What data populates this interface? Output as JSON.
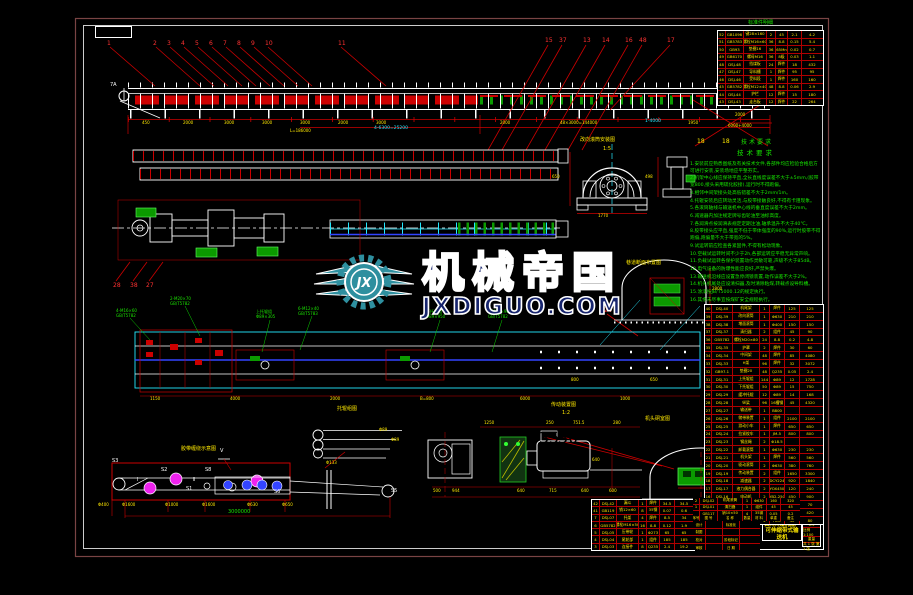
{
  "watermark": {
    "logo_initials": "JX",
    "brand": "机械帝国",
    "site": "JXDIGUO.COM"
  },
  "colors": {
    "red": "#cc1111",
    "yellow": "#ffe800",
    "green": "#1ae300",
    "cyan": "#25e9ff",
    "white": "#ffffff",
    "magenta": "#ee22ee",
    "blue": "#3344ff",
    "frame_outer": "#7a4444",
    "frame_inner": "#ffffff",
    "watermark_teal": "#2e8f9f",
    "watermark_navy": "#17256e"
  },
  "callouts": {
    "top_left": [
      "1",
      "2",
      "3",
      "4",
      "5",
      "6",
      "7",
      "8",
      "9",
      "10",
      "11"
    ],
    "top_right": [
      "15",
      "37",
      "13",
      "14",
      "16",
      "48",
      "17"
    ],
    "mid_left": [
      "28",
      "38",
      "27"
    ],
    "band3": [
      "24"
    ],
    "bottom": [
      "35",
      "30"
    ],
    "head_label": "7A"
  },
  "dims": {
    "top_row": [
      "450",
      "2000",
      "3000",
      "3000",
      "3000",
      "2000",
      "3000",
      "2000",
      "48×3000=144000",
      "1950"
    ],
    "top_row2": [
      "L=186000"
    ],
    "top_cyan": [
      "4-6300=25200",
      "1-4000"
    ],
    "band3_row": [
      "1150",
      "4000",
      "2000",
      "B=800",
      "6000",
      "1000"
    ],
    "band3_extra": [
      "800",
      "650"
    ],
    "detail_a": [
      "650",
      "1770"
    ],
    "detail_b": [
      "498"
    ],
    "tunnel_c": [
      "2800"
    ],
    "tunnel_d": [
      "650"
    ],
    "drive_top": [
      "1250",
      "250",
      "751.5",
      "280"
    ],
    "drive_bottom": [
      "500",
      "944",
      "640",
      "715",
      "640",
      "600"
    ],
    "drive_right": [
      "640"
    ],
    "head_leader": [
      "2000",
      "6000+4000"
    ]
  },
  "sections": {
    "detail_a_title": "改向滚筒安装图",
    "detail_a_scale": "1:5",
    "tunnel_c_title": "巷道断面布置图",
    "drive_title": "传动装置图",
    "drive_scale": "1:2",
    "rollers_title": "托辊组图",
    "rollers_labels": [
      "Φ89",
      "Φ89",
      "Φ133"
    ],
    "tunnel_d_title": "机头硐室图",
    "belt_title": "胶带缠绕示意图",
    "standard_label": "标准件明细"
  },
  "belt": {
    "labels": [
      "S3",
      "S2",
      "S8",
      "S1",
      "S6",
      "S5"
    ],
    "marks": [
      "Ⅰ",
      "Ⅱ"
    ],
    "v": "V",
    "phi": [
      "Φ400",
      "Φ1600",
      "Φ1000",
      "Φ1600",
      "Φ630",
      "Φ650"
    ],
    "total": "3000000"
  },
  "green_codes": [
    [
      "4-M16×60",
      "GB/T5782"
    ],
    [
      "2-M20×70",
      "GB/T5782"
    ],
    [
      "上托辊组",
      "Φ89×305"
    ],
    [
      "6-M12×40",
      "GB/T5783"
    ],
    [
      "下托辊组",
      "Φ89×950"
    ],
    [
      "2-M24×90",
      "GB/T5782"
    ]
  ],
  "notes": {
    "title": "技术要求",
    "lines": [
      "安装前应熟悉图纸及有关技术文件,各部件均应检验合格后方可进行安装,安装场地应平整夯实。",
      "机架中心线应保持平直,全长直线度误差不大于±5mm,(胶带宽800,接头采用硫化胶接),运行时不得跑偏。",
      "相邻中间架接头处高低错差不大于2mm/1m。",
      "托辊安装后应转动灵活,与胶带接触良好,不得有卡阻现象。",
      "各滚筒轴线与输送机中心线的垂直度误差不大于2mm。",
      "减速器内加注规定牌号齿轮油至油标高度。",
      "各润滑点按润滑表规定定期注油,轴承温升不大于40℃。",
      "胶带接头应平直,强度不低于带体强度的90%,运行时胶带不得跑偏,跑偏量不大于带宽的5%。",
      "试运转前应检查各紧固件,不得有松动现象。",
      "空载试运转时间不少于2h,各部运转应平稳无异常声响。",
      "负载试运转各保护装置动作灵敏可靠,声级不大于85dB。",
      "电气设备的防爆性能应良好,严禁失爆。",
      "输送机沿线应设置急停闭锁装置,动作误差不大于2%。",
      "机头机尾处应设清扫器,及时清除粘煤,转载点设导料槽。",
      "涂漆按JB/T5000.12的规定执行。",
      "其余未尽事宜按煤矿安全规程执行。"
    ]
  },
  "tables": {
    "top_right": {
      "rows": [
        [
          "52",
          "GB1096",
          "键28×160",
          "2",
          "45",
          "2.1",
          "4.2"
        ],
        [
          "51",
          "GB5783",
          "螺栓M16×60",
          "36",
          "8.8",
          "0.15",
          "5.4"
        ],
        [
          "50",
          "GB93",
          "垫圈16",
          "36",
          "65Mn",
          "0.02",
          "0.7"
        ],
        [
          "49",
          "GB6170",
          "螺母M16",
          "36",
          "8级",
          "0.03",
          "1.1"
        ],
        [
          "48",
          "DSJ-48",
          "挡煤板",
          "24",
          "焊件",
          "18",
          "432"
        ],
        [
          "47",
          "DSJ-47",
          "导料槽",
          "1",
          "焊件",
          "95",
          "95"
        ],
        [
          "46",
          "DSJ-46",
          "受料段",
          "1",
          "焊件",
          "160",
          "160"
        ],
        [
          "45",
          "GB5782",
          "螺栓M12×40",
          "48",
          "8.8",
          "0.06",
          "2.9"
        ],
        [
          "44",
          "DSJ-44",
          "护栏",
          "12",
          "焊件",
          "15",
          "180"
        ],
        [
          "43",
          "DSJ-43",
          "走台板",
          "12",
          "焊件",
          "22",
          "264"
        ]
      ]
    },
    "bom": {
      "rows": [
        [
          "40",
          "DSJ-40",
          "机尾架",
          "1",
          "焊件",
          "125",
          "125"
        ],
        [
          "39",
          "DSJ-39",
          "改向滚筒",
          "1",
          "Φ630",
          "210",
          "210"
        ],
        [
          "38",
          "DSJ-38",
          "增面滚筒",
          "1",
          "Φ400",
          "150",
          "150"
        ],
        [
          "37",
          "DSJ-37",
          "清扫器",
          "2",
          "组件",
          "45",
          "90"
        ],
        [
          "36",
          "GB5782",
          "螺栓M20×80",
          "24",
          "8.8",
          "0.2",
          "4.8"
        ],
        [
          "35",
          "DSJ-35",
          "护罩",
          "2",
          "焊件",
          "30",
          "60"
        ],
        [
          "34",
          "DSJ-34",
          "中间架",
          "48",
          "焊件",
          "85",
          "4080"
        ],
        [
          "33",
          "DSJ-33",
          "H架",
          "96",
          "焊件",
          "32",
          "3072"
        ],
        [
          "32",
          "GB97.1",
          "垫圈20",
          "48",
          "Q235",
          "0.05",
          "2.4"
        ],
        [
          "31",
          "DSJ-31",
          "上托辊组",
          "144",
          "Φ89",
          "12",
          "1728"
        ],
        [
          "30",
          "DSJ-30",
          "下托辊组",
          "50",
          "Φ89",
          "15",
          "750"
        ],
        [
          "29",
          "DSJ-29",
          "缓冲托辊",
          "12",
          "Φ89",
          "14",
          "168"
        ],
        [
          "28",
          "DSJ-28",
          "纵梁",
          "96",
          "16槽钢",
          "45",
          "4320"
        ],
        [
          "27",
          "DSJ-27",
          "输送带",
          "1",
          "B800",
          "",
          ""
        ],
        [
          "26",
          "DSJ-26",
          "储带装置",
          "1",
          "组件",
          "2100",
          "2100"
        ],
        [
          "25",
          "DSJ-25",
          "游动小车",
          "1",
          "焊件",
          "650",
          "650"
        ],
        [
          "24",
          "DSJ-24",
          "拉紧绞车",
          "1",
          "JM-5",
          "800",
          "800"
        ],
        [
          "23",
          "DSJ-23",
          "钢丝绳",
          "2",
          "Φ18.5",
          "",
          ""
        ],
        [
          "22",
          "DSJ-22",
          "卸载滚筒",
          "1",
          "Φ630",
          "230",
          "230"
        ],
        [
          "21",
          "DSJ-21",
          "机头架",
          "1",
          "焊件",
          "560",
          "560"
        ],
        [
          "20",
          "DSJ-20",
          "驱动滚筒",
          "2",
          "Φ630",
          "380",
          "760"
        ],
        [
          "19",
          "DSJ-19",
          "传动装置",
          "2",
          "组件",
          "1650",
          "3300"
        ],
        [
          "18",
          "DSJ-18",
          "减速器",
          "2",
          "DCY224",
          "920",
          "1840"
        ],
        [
          "17",
          "DSJ-17",
          "液力偶合器",
          "2",
          "YOX450",
          "120",
          "240"
        ],
        [
          "16",
          "DSJ-16",
          "电动机",
          "2",
          "YB2-250",
          "450",
          "900"
        ],
        [
          "15",
          "DSJ-15",
          "逆止器",
          "2",
          "NJ30",
          "35",
          "70"
        ],
        [
          "14",
          "DSJ-14",
          "底座",
          "2",
          "焊件",
          "210",
          "420"
        ],
        [
          "13",
          "DSJ-13",
          "联轴器",
          "2",
          "HL6",
          "40",
          "80"
        ]
      ]
    },
    "small": {
      "rows": [
        [
          "42",
          "DSJ-42",
          "漏斗",
          "1",
          "焊件",
          "34.5",
          "34.5"
        ],
        [
          "41",
          "GB119",
          "销12×60",
          "8",
          "35钢",
          "0.07",
          "0.6"
        ],
        [
          "7",
          "DSJ-07",
          "托架",
          "4",
          "焊件",
          "8.5",
          "34"
        ],
        [
          "6",
          "GB5782",
          "螺栓M16×50",
          "16",
          "8.8",
          "0.12",
          "1.9"
        ],
        [
          "5",
          "DSJ-05",
          "压带轮",
          "1",
          "Φ273",
          "65",
          "65"
        ],
        [
          "4",
          "DSJ-04",
          "尾轮部",
          "1",
          "组件",
          "185",
          "185"
        ],
        [
          "3",
          "DSJ-03",
          "连接件",
          "8",
          "Q235",
          "2.4",
          "19.2"
        ]
      ]
    },
    "title_block": {
      "parts_rows": [
        [
          "2",
          "DSJ-02",
          "机尾滚筒",
          "1",
          "Φ630",
          "160",
          "320"
        ],
        [
          "1",
          "DSJ-01",
          "清扫器",
          "1",
          "组件",
          "45",
          "45"
        ],
        [
          "",
          "GB117",
          "销10×50",
          "4",
          "35钢",
          "0.05",
          "0.2"
        ]
      ],
      "header": [
        "序号",
        "图 号",
        "名 称",
        "数量",
        "材 料",
        "单重",
        "备注"
      ],
      "left_cells": [
        [
          "设计",
          "",
          "标准化",
          ""
        ],
        [
          "制图",
          "",
          "",
          ""
        ],
        [
          "校对",
          "",
          "阶段标记",
          ""
        ],
        [
          "审核",
          "",
          "日 期",
          ""
        ]
      ],
      "company": "四川川煤机械厂",
      "product": "可伸缩带式输送机",
      "right_rows": [
        "6.3",
        "比例 1:100",
        "重量",
        "共 1 张  第 1 张"
      ]
    }
  }
}
